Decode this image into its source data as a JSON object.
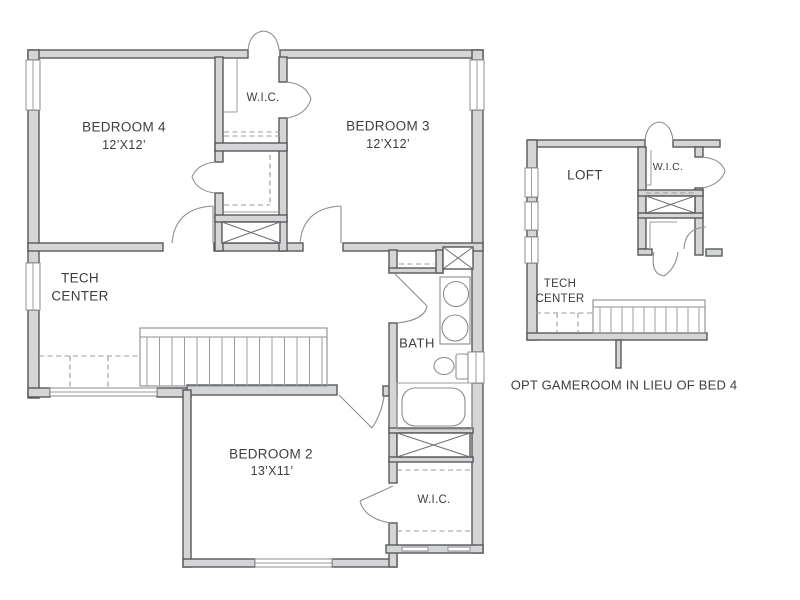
{
  "plan_type": "second-floor-plan",
  "colors": {
    "background": "#ffffff",
    "wall_edge": "#57585a",
    "wall_fill": "#d4d5d7",
    "thin_line": "#8b8d90",
    "dash_line": "#97999b",
    "text": "#3e3e40"
  },
  "main_plan": {
    "bedroom4": {
      "name": "BEDROOM 4",
      "dims": "12’X12’"
    },
    "bedroom3": {
      "name": "BEDROOM 3",
      "dims": "12’X12’"
    },
    "bedroom2": {
      "name": "BEDROOM 2",
      "dims": "13’X11’"
    },
    "wic_top": {
      "name": "W.I.C."
    },
    "wic_bottom": {
      "name": "W.I.C."
    },
    "bath": {
      "name": "BATH"
    },
    "tech_center": {
      "line1": "TECH",
      "line2": "CENTER"
    }
  },
  "option_plan": {
    "loft": {
      "name": "LOFT"
    },
    "wic": {
      "name": "W.I.C."
    },
    "tech_center": {
      "line1": "TECH",
      "line2": "CENTER"
    },
    "caption": "OPT GAMEROOM IN LIEU OF BED 4"
  }
}
